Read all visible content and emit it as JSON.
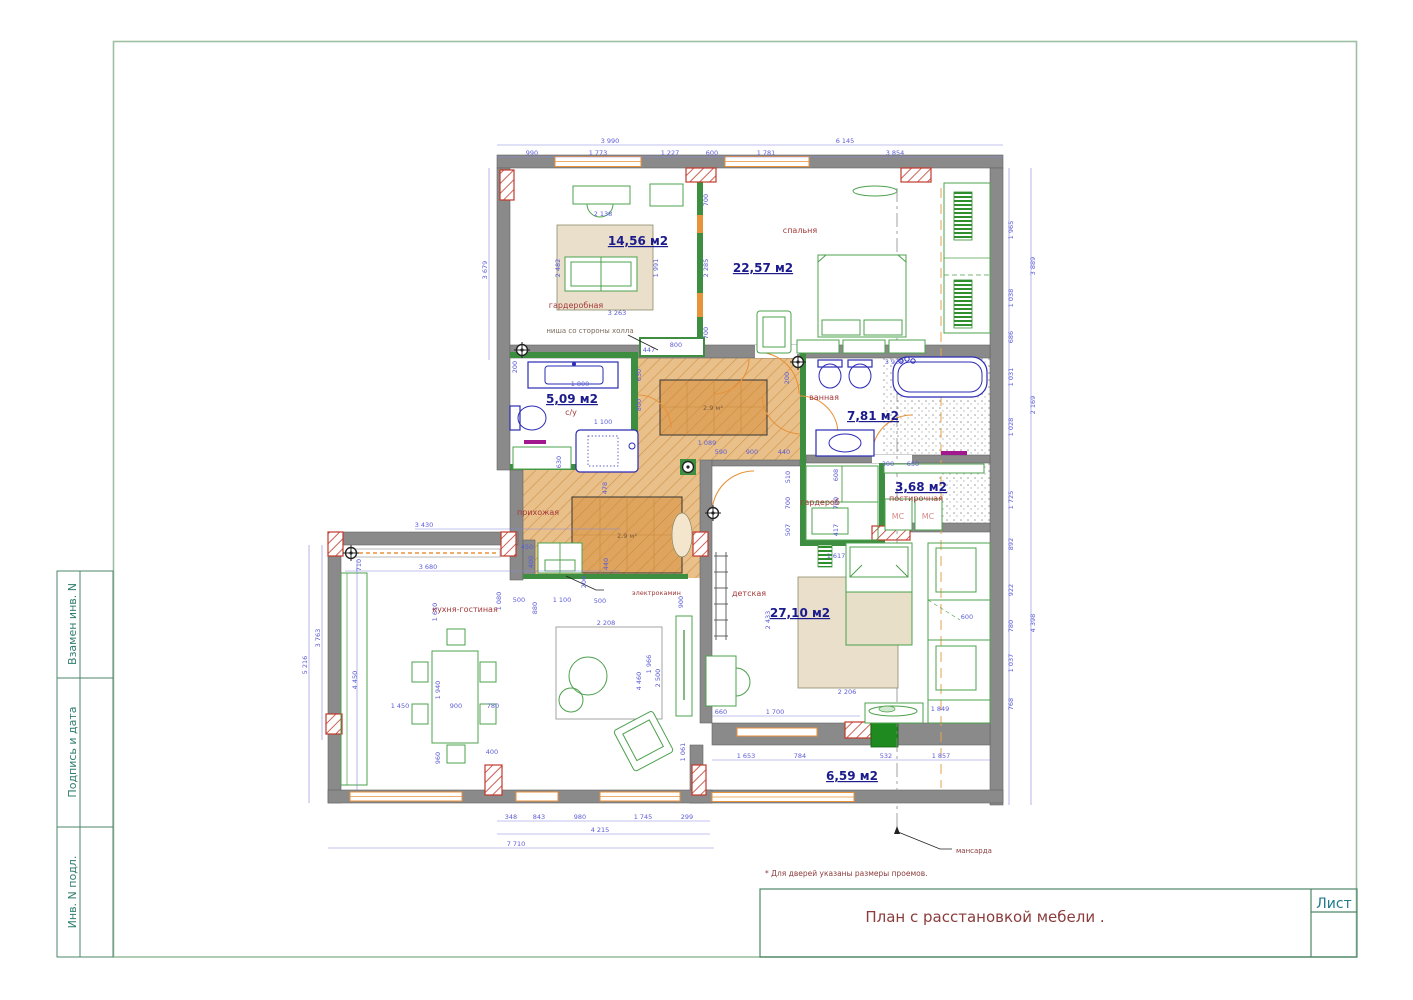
{
  "frame": {
    "sidebar": [
      "Взамен инв. N",
      "Подпись и дата",
      "Инв. N подл."
    ],
    "note": "* Для дверей указаны размеры проемов.",
    "title": "План с расстановкой мебели .",
    "sheet_label": "Лист"
  },
  "rooms": [
    {
      "name": "гардеробная",
      "area": "14,56 м2"
    },
    {
      "name": "спальня",
      "area": "22,57 м2"
    },
    {
      "name": "с/у",
      "area": "5,09 м2"
    },
    {
      "name": "ванная",
      "area": "7,81 м2"
    },
    {
      "name": "прихожая"
    },
    {
      "name": "гардероб"
    },
    {
      "name": "постирочная",
      "area": "3,68 м2"
    },
    {
      "name": "детская",
      "area": "27,10 м2"
    },
    {
      "name": "кухня-гостиная"
    },
    {
      "area": "6,59 м2"
    }
  ],
  "labels": {
    "niche": "ниша со стороны холла",
    "fireplace": "электрокамин",
    "attic": "мансарда",
    "washer1": "МС",
    "washer2": "МС",
    "rug_hall_1": "2.9 м²",
    "rug_hall_2": "2.9 м²"
  },
  "dims": [
    "3 990",
    "6 145",
    "990",
    "1 773",
    "1 227",
    "600",
    "1 781",
    "3 854",
    "3 679",
    "200",
    "1 965",
    "1 038",
    "686",
    "1 031",
    "1 028",
    "1 725",
    "892",
    "922",
    "780",
    "1 037",
    "768",
    "3 889",
    "2 169",
    "4 398",
    "2 138",
    "2 482",
    "1 991",
    "3 263",
    "700",
    "2 285",
    "700",
    "447",
    "800",
    "3 928",
    "200",
    "1 800",
    "1 100",
    "630",
    "800",
    "630",
    "1 089",
    "590",
    "900",
    "440",
    "510",
    "700",
    "507",
    "608",
    "700",
    "417",
    "300",
    "650",
    "478",
    "450",
    "400",
    "440",
    "3 430",
    "3 680",
    "710",
    "500",
    "1 100",
    "500",
    "1 080",
    "880",
    "900",
    "5 216",
    "3 763",
    "4 450",
    "1 610",
    "1 450",
    "900",
    "780",
    "1 940",
    "960",
    "400",
    "2 208",
    "4 460",
    "1 966",
    "2 500",
    "1 061",
    "348",
    "843",
    "980",
    "1 745",
    "299",
    "4 215",
    "7 710",
    "1 617",
    "2 433",
    "2 206",
    "600",
    "660",
    "1 700",
    "1 849",
    "1 653",
    "784",
    "532",
    "1 857",
    "200"
  ],
  "colors": {
    "wall": "#8a8a8a",
    "partition": "#3e8e41",
    "window": "#e8923a",
    "dimension": "#5c5cd6",
    "area_text": "#1b1b8c",
    "room_text": "#a33a3a",
    "plumbing": "#2b2bb5",
    "hall_floor": "#e9c08a",
    "frame_border": "#9dbfa2",
    "titleblock_border": "#4e8668",
    "sheet_text": "#1f7a8c",
    "column_hatch": "#b03030",
    "towel_rail": "#a2188f",
    "door_fill": "#1f8a1f"
  }
}
